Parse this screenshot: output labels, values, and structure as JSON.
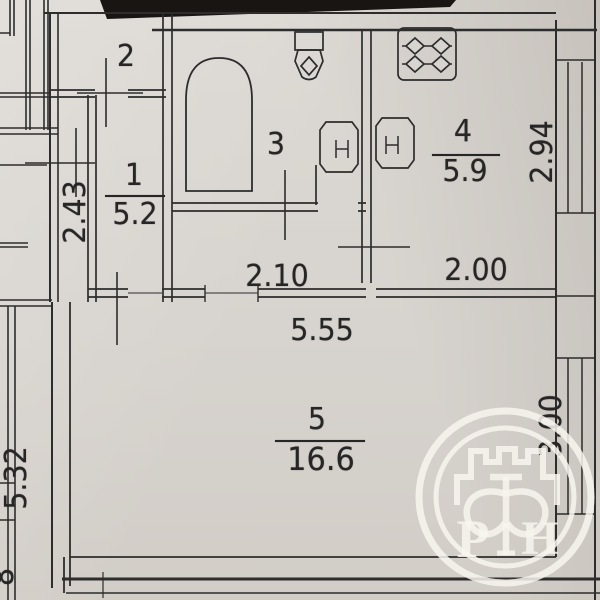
{
  "rooms": {
    "storage": {
      "number": "2"
    },
    "hall": {
      "number": "1",
      "area": "5.2"
    },
    "bathroom": {
      "number": "3"
    },
    "kitchen": {
      "number": "4",
      "area": "5.9"
    },
    "living": {
      "number": "5",
      "area": "16.6"
    }
  },
  "dimensions": {
    "hall_depth": "2.43",
    "corridor_width": "2.10",
    "kitchen_width": "2.00",
    "kitchen_depth": "2.94",
    "living_width": "5.55",
    "living_depth": "3.00",
    "neighbor_left": "5.32",
    "edge_fragment": "8"
  },
  "watermark": {
    "letter_left": "Р",
    "letter_center": "Ф",
    "letter_right": "Н"
  },
  "colors": {
    "ink": "#2b2b2b",
    "paper": "#d8d4cf",
    "watermark": "#f7f4ec"
  }
}
